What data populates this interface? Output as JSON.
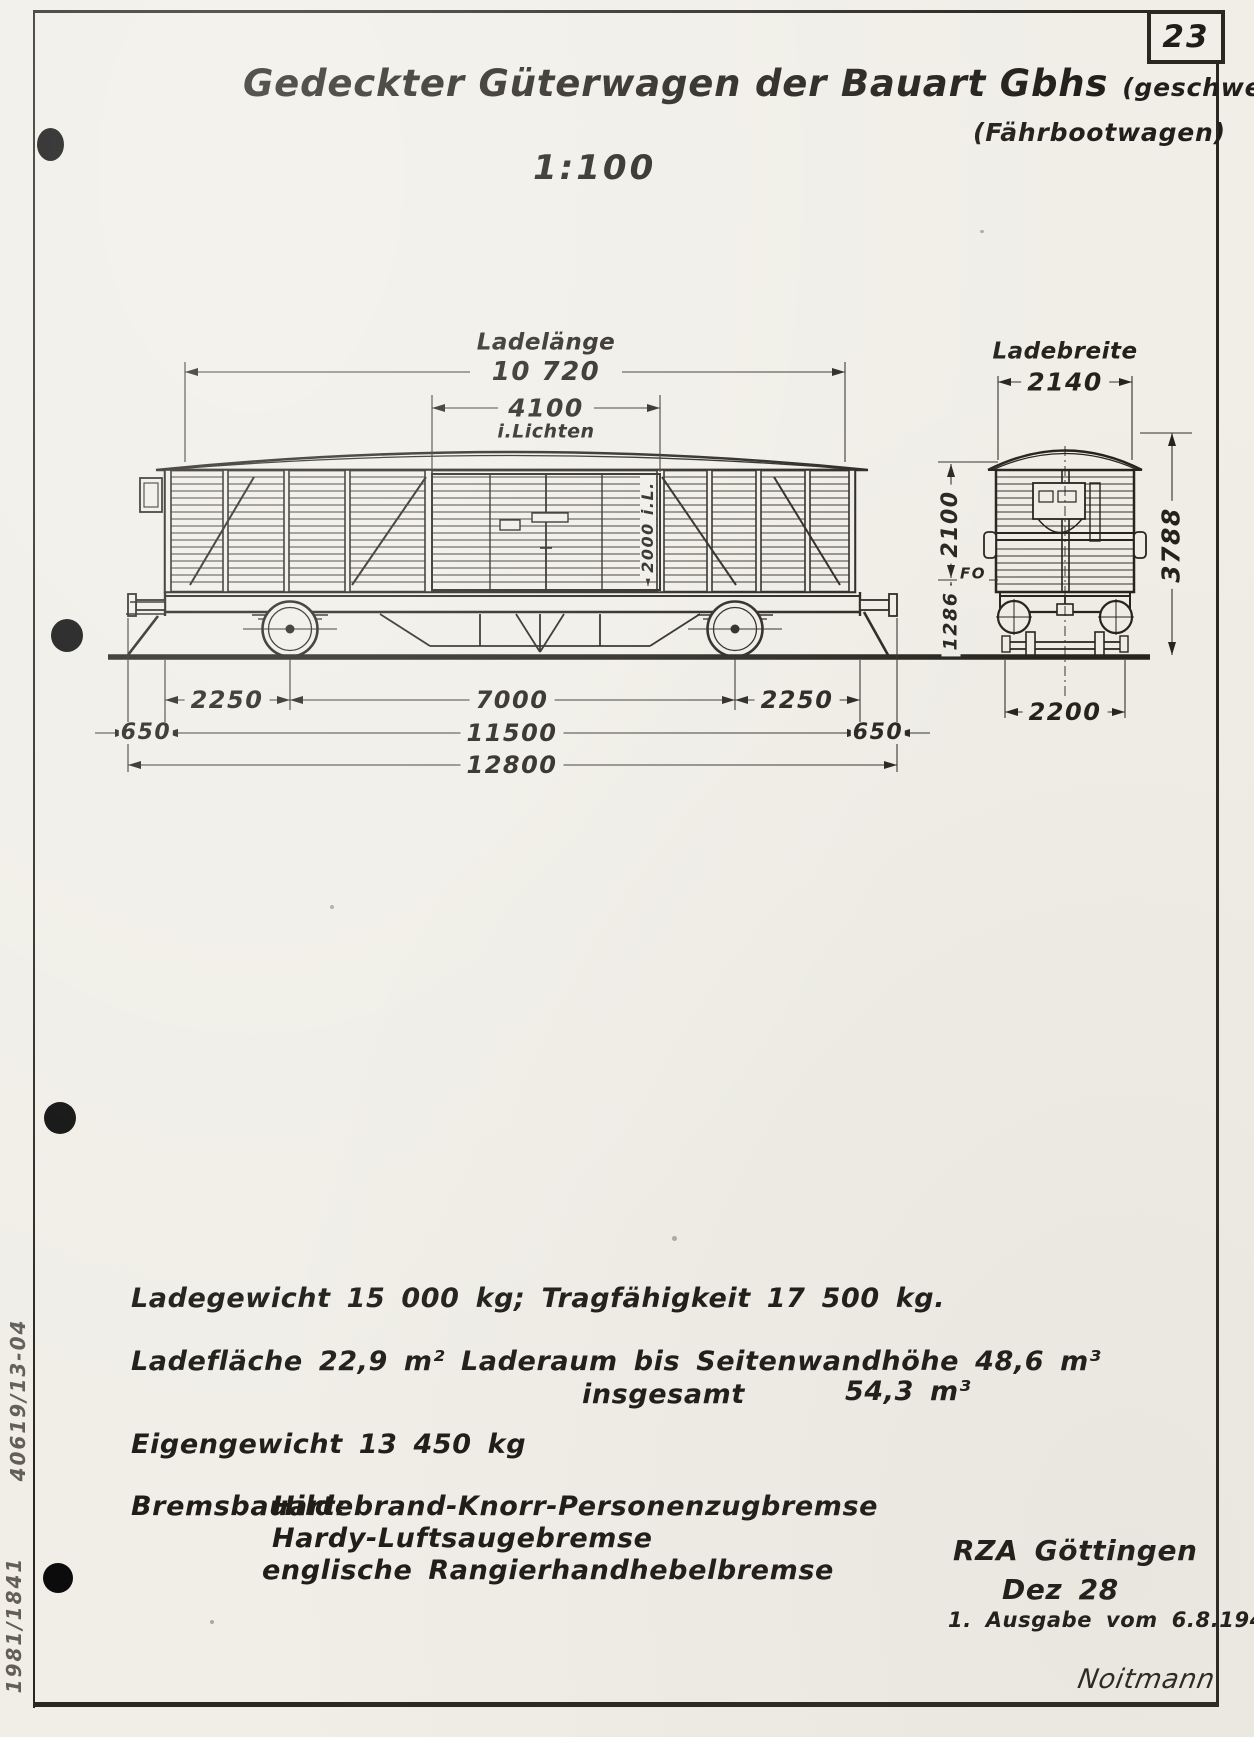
{
  "page": {
    "number": "23"
  },
  "title": {
    "main": "Gedeckter Güterwagen der Bauart Gbhs",
    "suffix": "(geschweißt)",
    "subtitle": "(Fährbootwagen)",
    "scale": "1:100"
  },
  "diagram": {
    "side_view": {
      "dims": {
        "load_length_label": "Ladelänge",
        "load_length": "10 720",
        "door_width": "4100",
        "door_width_note": "i.Lichten",
        "door_height": "2000 i.L.",
        "overhang_left": "650",
        "axle_left": "2250",
        "axle_spacing": "7000",
        "axle_right": "2250",
        "frame_length": "11500",
        "overhang_right": "650",
        "total_length": "12800"
      }
    },
    "end_view": {
      "dims": {
        "load_width_label": "Ladebreite",
        "load_width": "2140",
        "inner_height": "2100",
        "floor_label": "FO",
        "floor_height": "1286",
        "total_height": "3788",
        "axle_guard_spacing": "2200"
      }
    }
  },
  "specs": {
    "line1": "Ladegewicht  15 000 kg; Tragfähigkeit  17 500 kg.",
    "line2": "Ladefläche  22,9 m²  Laderaum bis Seitenwandhöhe  48,6 m³",
    "line3_label": "insgesamt",
    "line3_value": "54,3 m³",
    "line4": "Eigengewicht  13 450 kg",
    "brake_label": "Bremsbauart:",
    "brakes": [
      "Hildebrand-Knorr-Personenzugbremse",
      "Hardy-Luftsaugebremse",
      "englische Rangierhandhebelbremse"
    ]
  },
  "footer": {
    "org": "RZA Göttingen",
    "date": "Dez 28",
    "edition": "1. Ausgabe vom 6.8.1948",
    "signature": "Noitmann"
  },
  "margin_notes": {
    "upper": "40619/13-04",
    "lower": "1981/1841"
  }
}
